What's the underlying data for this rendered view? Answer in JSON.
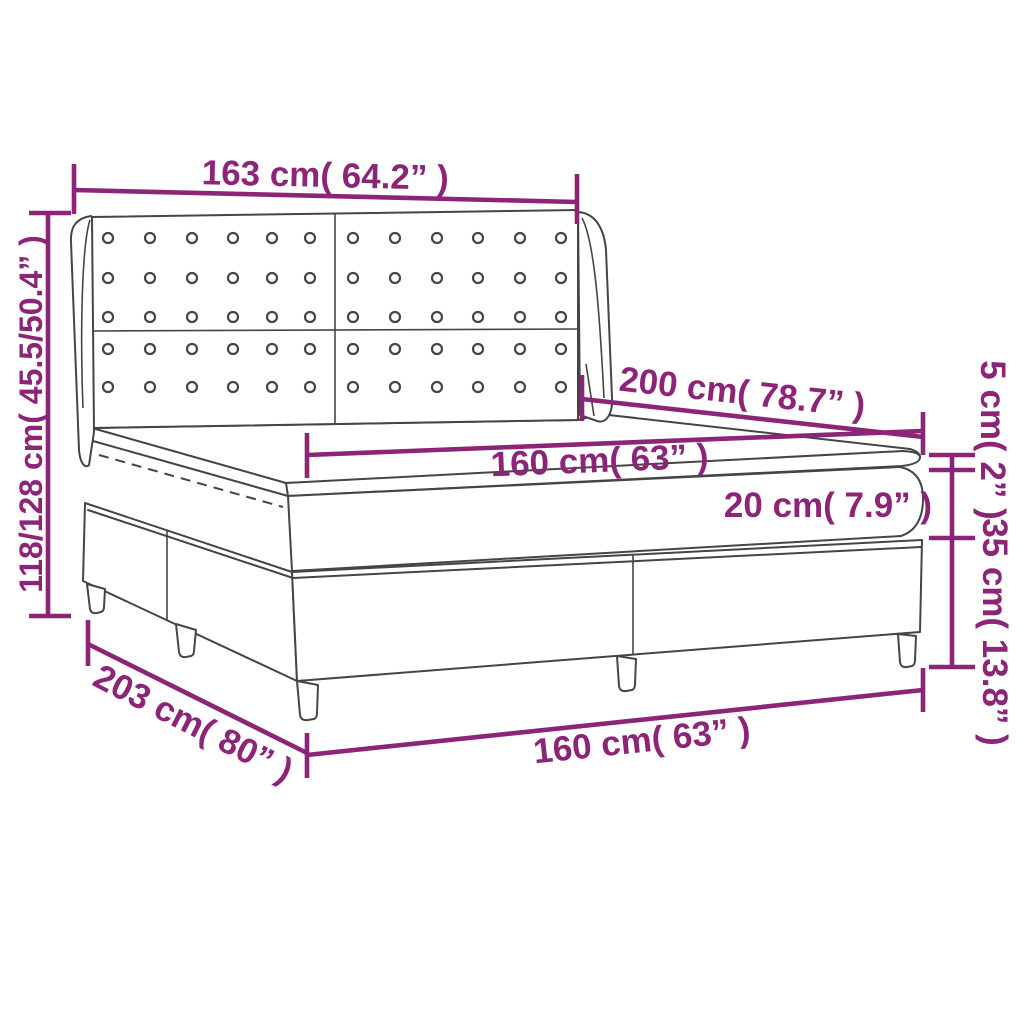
{
  "diagram": {
    "description": "Dimension diagram of a box spring bed with tufted wing headboard, pocket top mattress and topper",
    "colors": {
      "accent": "#8C2577",
      "line": "#454545",
      "background": "#FFFFFF"
    },
    "labels": {
      "headboard_width": "163 cm( 64.2” )",
      "bed_height": "118/128 cm( 45.5/50.4” )",
      "bed_depth": "200 cm( 78.7” )",
      "mattress_width": "160 cm( 63” )",
      "mattress_height": "20 cm( 7.9” )",
      "topper_height": "5 cm( 2” )",
      "base_height": "35 cm( 13.8” )",
      "base_depth": "203 cm( 80” )",
      "base_width": "160 cm( 63” )"
    }
  }
}
